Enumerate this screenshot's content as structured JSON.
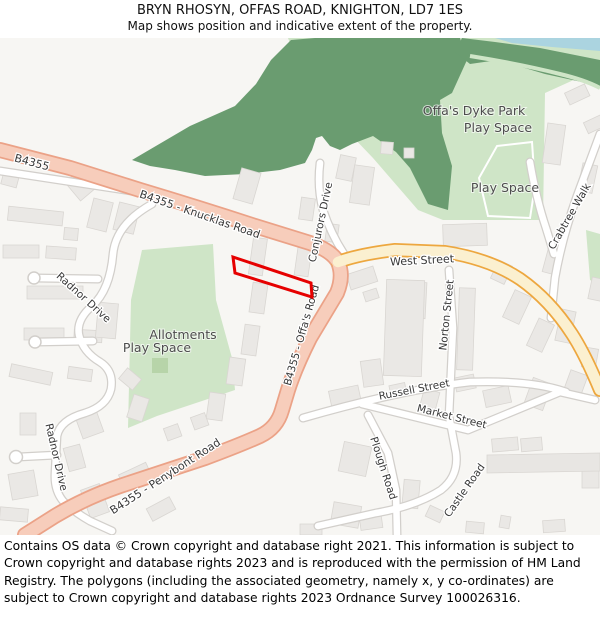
{
  "header": {
    "title": "BRYN RHOSYN, OFFAS ROAD, KNIGHTON, LD7 1ES",
    "subtitle": "Map shows position and indicative extent of the property."
  },
  "map": {
    "labels": {
      "b4355": "B4355",
      "knucklas": "B4355 - Knucklas Road",
      "conjurors": "Conjurors Drive",
      "offas": "B4355 - Offa's Road",
      "west": "West Street",
      "crabtree": "Crabtree Walk",
      "norton": "Norton Street",
      "russell": "Russell Street",
      "market": "Market Street",
      "plough": "Plough Road",
      "castle": "Castle Road",
      "penybont": "B4355 - Penybont Road",
      "radnor": "Radnor Drive",
      "offas_dyke_line1": "Offa's Dyke Park",
      "offas_dyke_line2": "Play Space",
      "play_space": "Play Space",
      "allotments_line1": "Allotments",
      "allotments_line2": "Play Space"
    },
    "colors": {
      "background": "#f7f6f3",
      "greenspace": "#cfe5c7",
      "woodland": "#6a9c70",
      "water": "#abd4e0",
      "building": "#eae8e5",
      "building_outline": "#d9d6d2",
      "road_primary_fill": "#f7cdbb",
      "road_primary_casing": "#eba287",
      "road_secondary_fill": "#fbf0d0",
      "road_secondary_casing": "#eda73f",
      "road_minor_casing": "#d2cfcb",
      "property_outline": "#e60000"
    }
  },
  "footer": {
    "copyright": "Contains OS data © Crown copyright and database right 2021. This information is subject to Crown copyright and database rights 2023 and is reproduced with the permission of HM Land Registry. The polygons (including the associated geometry, namely x, y co-ordinates) are subject to Crown copyright and database rights 2023 Ordnance Survey 100026316."
  }
}
